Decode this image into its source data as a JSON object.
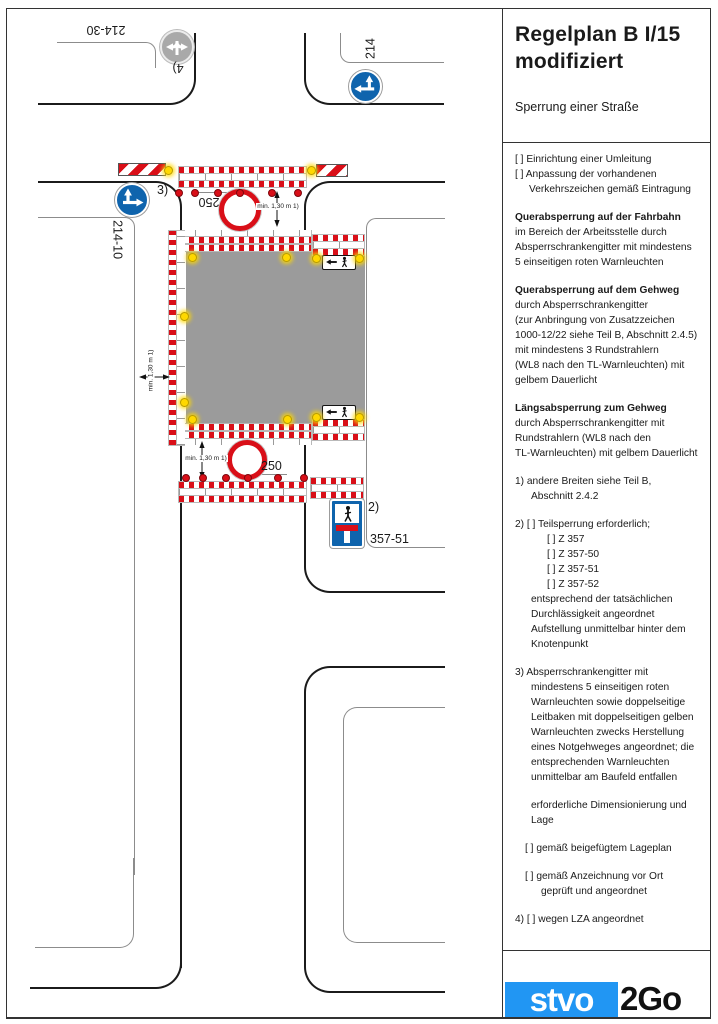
{
  "theme": {
    "signal_red": "#d90f18",
    "sign_blue": "#0f64ad",
    "work_area_gray": "#9b9b9b",
    "inactive_sign_gray": "#a9a9a9",
    "lamp_yellow": "#ffd800",
    "logo_blue": "#2196f3"
  },
  "diagram": {
    "labels": {
      "sign_214_30": "214-30",
      "footnote_4": "4)",
      "sign_214": "214",
      "footnote_3": "3)",
      "sign_250_top": "250",
      "min_width_top": "min. 1,30 m 1)",
      "sign_214_10": "214-10",
      "min_width_left": "min. 1,30 m 1)",
      "min_width_bottom": "min. 1,30 m 1)",
      "sign_250_bottom": "250",
      "footnote_2": "2)",
      "sign_357_51": "357-51"
    }
  },
  "panel": {
    "title_line1": "Regelplan B I/15",
    "title_line2": "modifiziert",
    "subtitle": "Sperrung einer Straße",
    "paragraphs": [
      {
        "lines": [
          {
            "t": "[ ] Einrichtung einer Umleitung"
          },
          {
            "t": "[ ] Anpassung der vorhandenen"
          },
          {
            "t": "Verkehrszeichen gemäß Eintragung",
            "i": 14
          }
        ]
      },
      {
        "lines": [
          {
            "t": "Querabsperrung auf der Fahrbahn",
            "b": 1
          },
          {
            "t": "im Bereich der Arbeitsstelle durch"
          },
          {
            "t": "Absperrschrankengitter mit mindestens"
          },
          {
            "t": "5 einseitigen roten Warnleuchten"
          }
        ]
      },
      {
        "lines": [
          {
            "t": "Querabsperrung auf dem Gehweg",
            "b": 1
          },
          {
            "t": "durch Absperrschrankengitter"
          },
          {
            "t": "(zur Anbringung von Zusatzzeichen"
          },
          {
            "t": "1000-12/22 siehe Teil B, Abschnitt 2.4.5)"
          },
          {
            "t": "mit mindestens 3 Rundstrahlern"
          },
          {
            "t": "(WL8 nach den TL-Warnleuchten) mit"
          },
          {
            "t": "gelbem Dauerlicht"
          }
        ]
      },
      {
        "lines": [
          {
            "t": "Längsabsperrung zum Gehweg",
            "b": 1
          },
          {
            "t": "durch Absperrschrankengitter mit"
          },
          {
            "t": "Rundstrahlern (WL8 nach den"
          },
          {
            "t": "TL-Warnleuchten) mit gelbem Dauerlicht"
          }
        ]
      },
      {
        "lines": [
          {
            "t": "1)  andere Breiten siehe Teil B,"
          },
          {
            "t": "Abschnitt 2.4.2",
            "i": 16
          }
        ]
      },
      {
        "lines": [
          {
            "t": "2) [ ] Teilsperrung erforderlich;"
          },
          {
            "t": "[ ] Z 357",
            "i": 32
          },
          {
            "t": "[ ] Z 357-50",
            "i": 32
          },
          {
            "t": "[ ] Z 357-51",
            "i": 32
          },
          {
            "t": "[ ] Z 357-52",
            "i": 32
          },
          {
            "t": "entsprechend der tatsächlichen",
            "i": 16
          },
          {
            "t": "Durchlässigkeit angeordnet",
            "i": 16
          },
          {
            "t": "Aufstellung unmittelbar hinter dem",
            "i": 16
          },
          {
            "t": "Knotenpunkt",
            "i": 16
          }
        ]
      },
      {
        "lines": [
          {
            "t": "3) Absperrschrankengitter mit"
          },
          {
            "t": "mindestens 5 einseitigen roten",
            "i": 16
          },
          {
            "t": "Warnleuchten sowie doppelseitige",
            "i": 16
          },
          {
            "t": "Leitbaken mit doppelseitigen gelben",
            "i": 16
          },
          {
            "t": "Warnleuchten zwecks Herstellung",
            "i": 16
          },
          {
            "t": "eines Notgehweges angeordnet; die",
            "i": 16
          },
          {
            "t": "entsprechenden Warnleuchten",
            "i": 16
          },
          {
            "t": "unmittelbar am Baufeld entfallen",
            "i": 16
          }
        ]
      },
      {
        "lines": [
          {
            "t": "erforderliche Dimensionierung und",
            "i": 16
          },
          {
            "t": "Lage",
            "i": 16
          }
        ]
      },
      {
        "lines": [
          {
            "t": "[ ] gemäß beigefügtem Lageplan",
            "i": 10
          }
        ]
      },
      {
        "lines": [
          {
            "t": "[ ] gemäß Anzeichnung vor Ort",
            "i": 10
          },
          {
            "t": "geprüft und angeordnet",
            "i": 26
          }
        ]
      },
      {
        "lines": [
          {
            "t": "4) [ ] wegen LZA angeordnet"
          }
        ]
      }
    ],
    "logo": {
      "text_blue": "stvo",
      "text_black": "2Go"
    }
  }
}
